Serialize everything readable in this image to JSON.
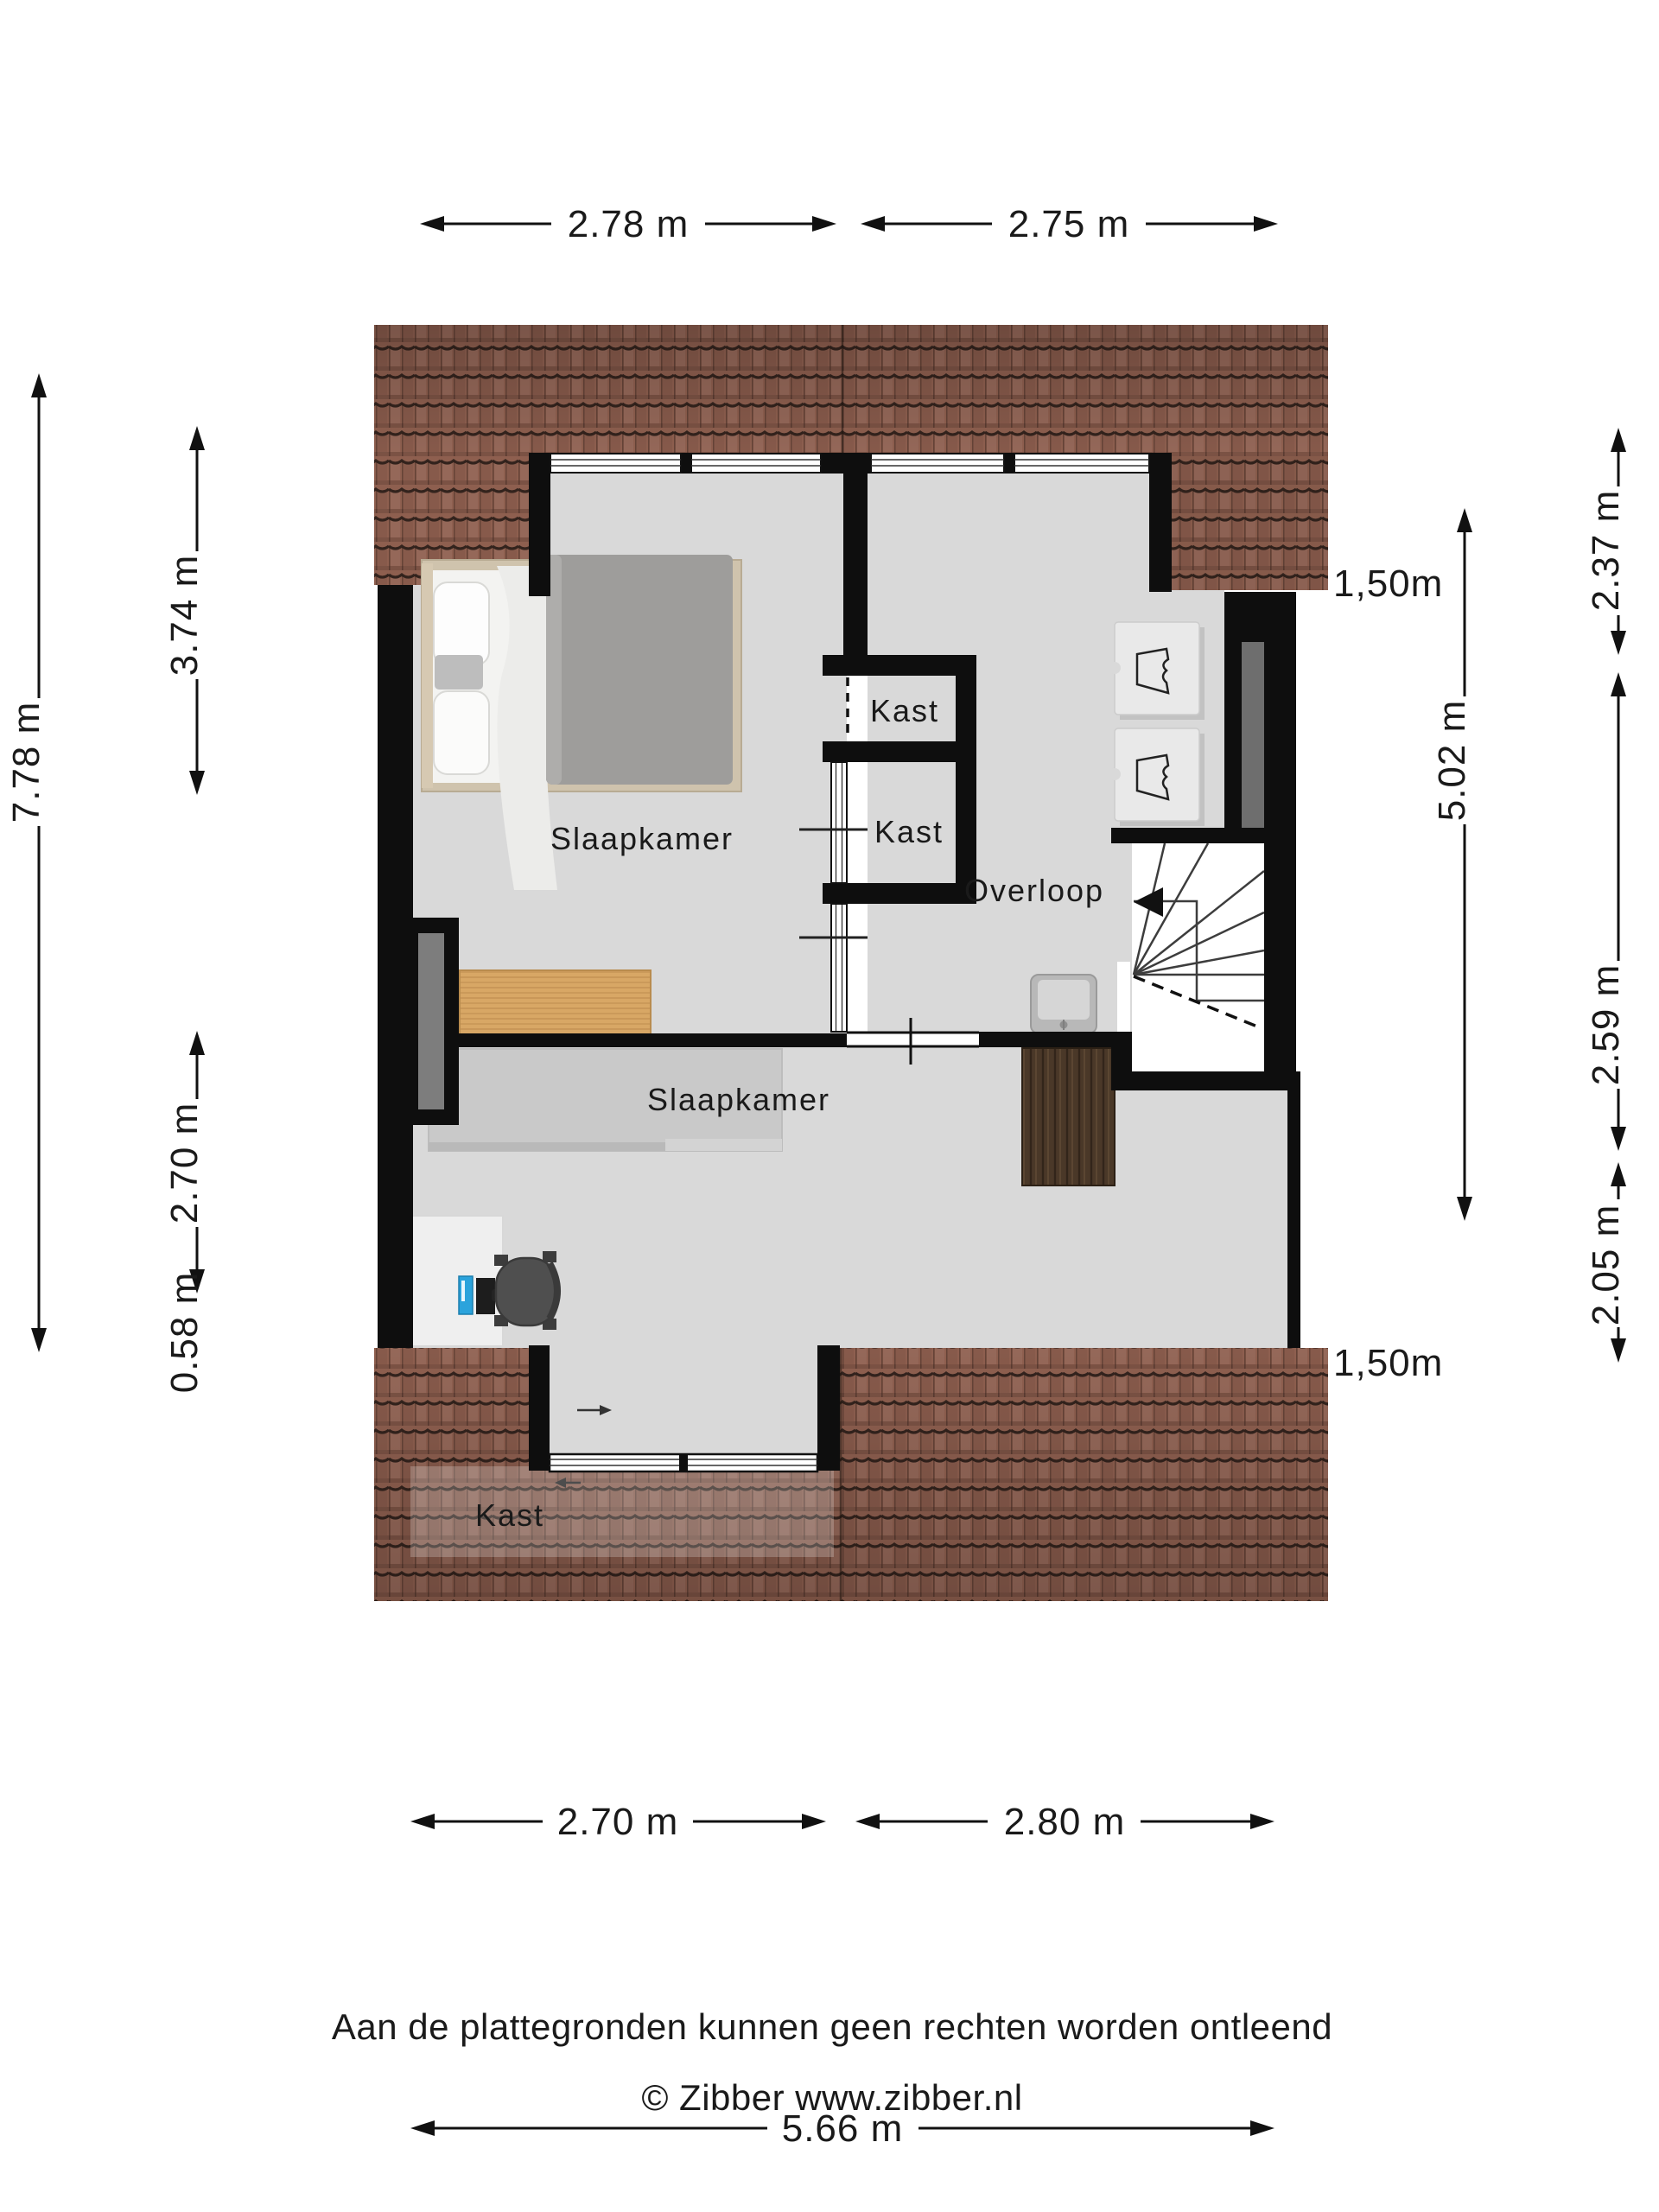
{
  "plan": {
    "rooms": {
      "bedroom1": {
        "label": "Slaapkamer"
      },
      "bedroom2": {
        "label": "Slaapkamer"
      },
      "landing": {
        "label": "Overloop"
      }
    },
    "closets": {
      "closet1": {
        "label": "Kast"
      },
      "closet2": {
        "label": "Kast"
      },
      "closet3": {
        "label": "Kast"
      }
    }
  },
  "dimensions": {
    "top": [
      {
        "label": "2.78 m"
      },
      {
        "label": "2.75 m"
      }
    ],
    "bottom": [
      {
        "label": "2.70 m"
      },
      {
        "label": "2.80 m"
      }
    ],
    "bottom_total": {
      "label": "5.66 m"
    },
    "left_outer": {
      "label": "7.78 m"
    },
    "left_inner": [
      {
        "label": "3.74 m"
      },
      {
        "label": "2.70 m"
      },
      {
        "label": "0.58 m"
      }
    ],
    "right_inner": {
      "label": "5.02 m"
    },
    "right_outer": [
      {
        "label": "2.37 m"
      },
      {
        "label": "2.59 m"
      },
      {
        "label": "2.05 m"
      }
    ],
    "knee_wall_top": {
      "label": "1,50m"
    },
    "knee_wall_bottom": {
      "label": "1,50m"
    }
  },
  "footer": {
    "line1": "Aan de plattegronden kunnen geen rechten worden ontleend",
    "line2": "© Zibber www.zibber.nl"
  },
  "colors": {
    "roof_tile": "#8e5f4f",
    "roof_line": "#33231d",
    "floor": "#d9d9d9",
    "wall": "#0e0e0e",
    "wood_light": "#d8a765",
    "cabinet_dark": "#4a3828",
    "wardrobe": "#c9c9c9",
    "computer_blue": "#2ba3dc",
    "glass_panel": "#7d7d7d"
  }
}
